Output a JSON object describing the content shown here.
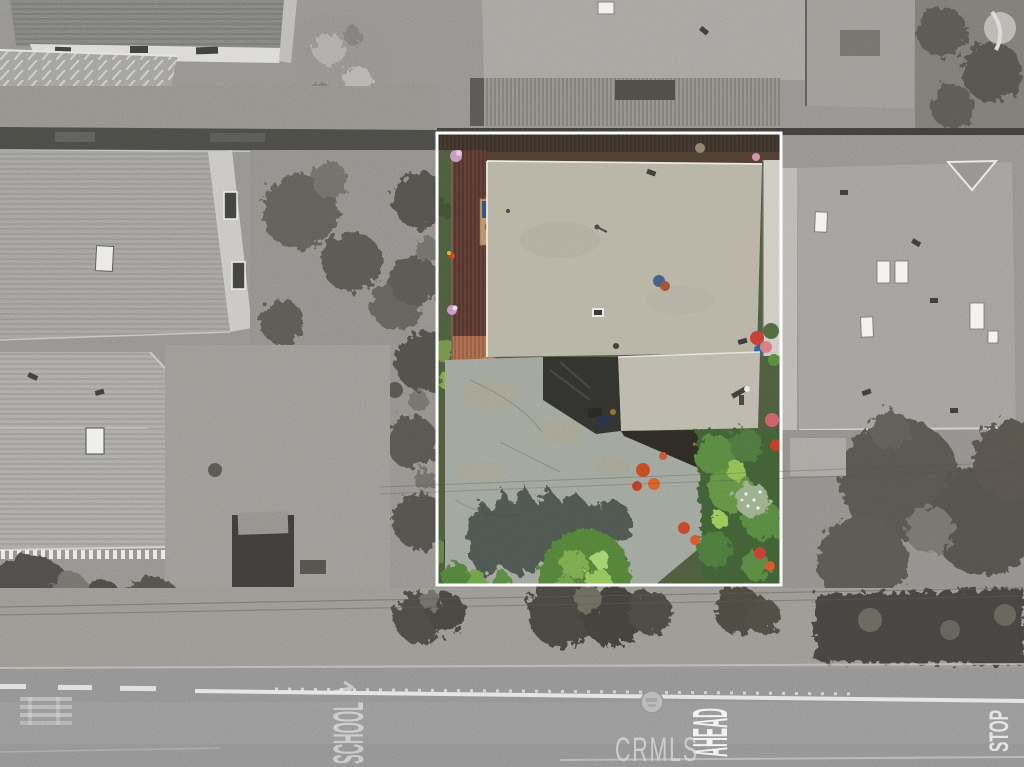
{
  "photo": {
    "kind": "aerial-drone-photo",
    "subject": "Overhead aerial view of a residential lot outlined in white; lot shown in color, surrounding neighborhood desaturated",
    "watermark_text": "CRMLS"
  },
  "road_markings": {
    "school_text": "SCHOOL",
    "ahead_text": "AHEAD",
    "stop_text": "STOP"
  },
  "colors": {
    "boundary": "#ffffff",
    "watermark": "#d2d2d2",
    "roof_gravel": "#b2ae9e",
    "garage_roof": "#b7b3a6",
    "deck_wood": "#5a3a32",
    "terracotta_deck": "#b5714f",
    "driveway_concrete": "#9aa096",
    "dark_asphalt": "#2f2f2c",
    "grass": "#49573a",
    "foliage_dark": "#3e5a33",
    "foliage_bright": "#8cbf58",
    "flower_red": "#c23a30",
    "flower_orange": "#d55a28",
    "flower_pink": "#d4757e",
    "asphalt_road": "#8c8c8c",
    "grayscale_roof": "#9d9b97"
  }
}
